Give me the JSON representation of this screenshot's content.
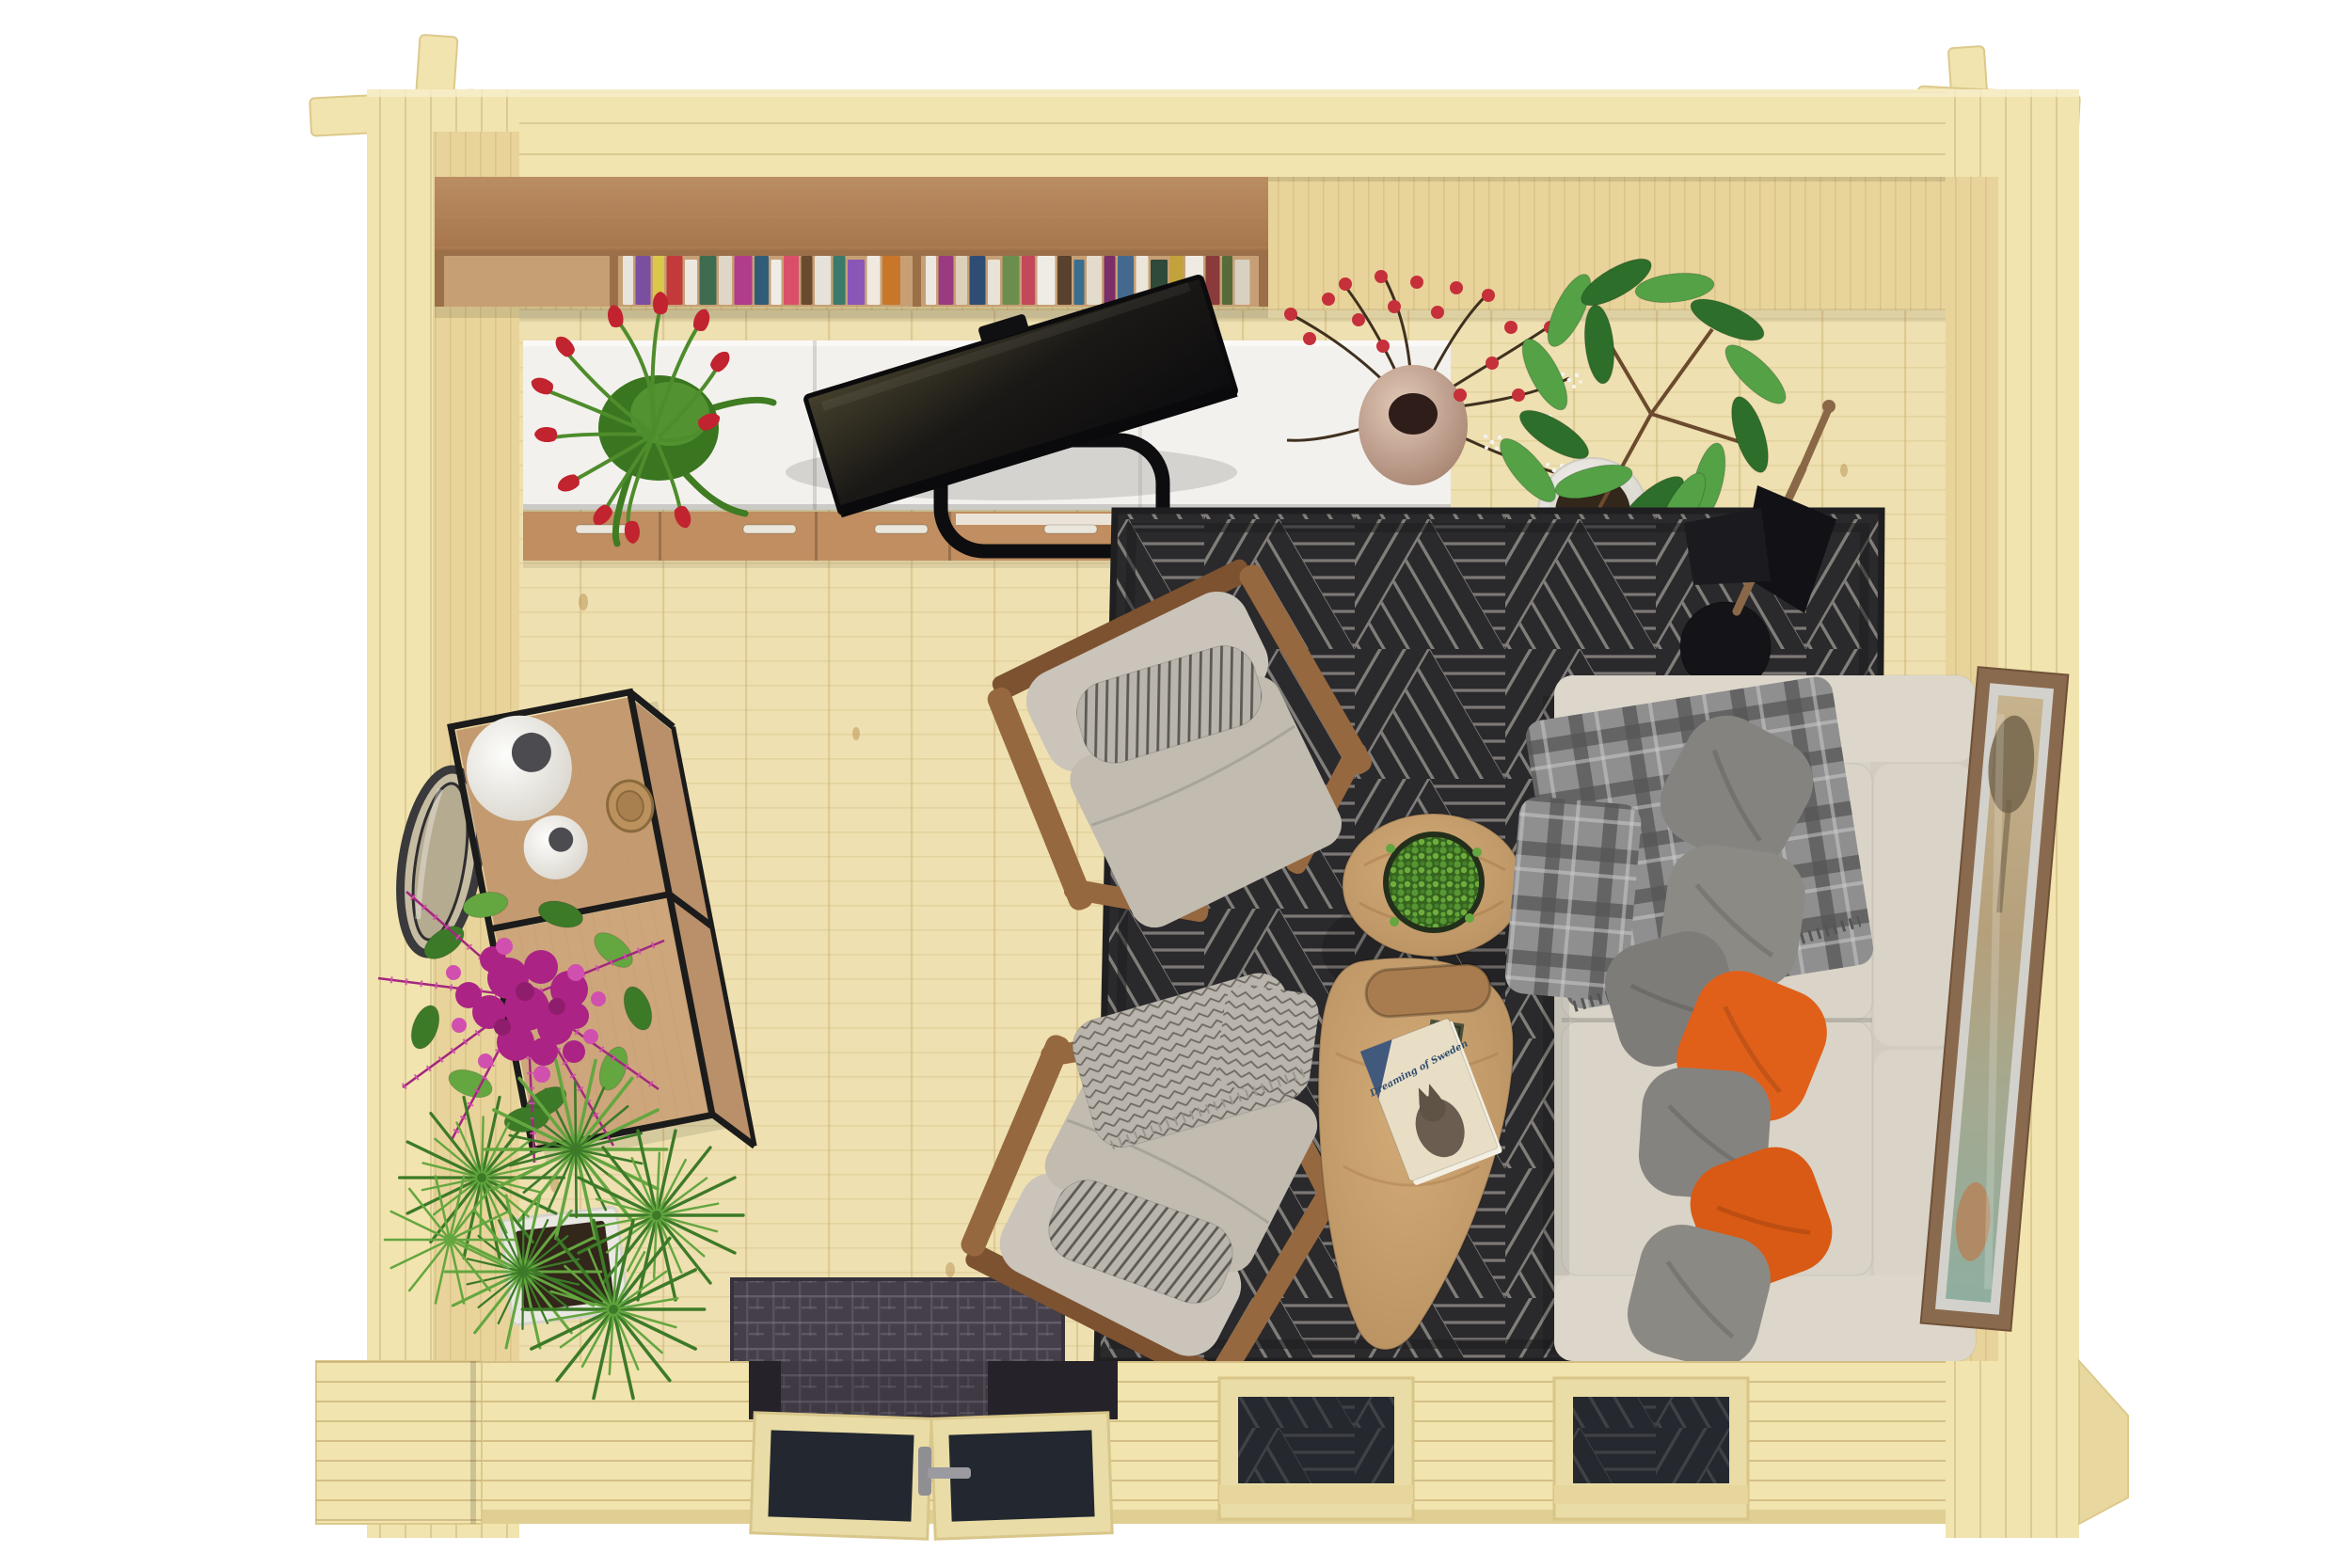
{
  "scene": {
    "description": "Top-down 3D render of a furnished log-cabin garden room (living room with sofa, armchairs, rug, desk wall and plants)",
    "book_title": "Dreaming of Sweden"
  },
  "palette": {
    "bg": "#ffffff",
    "wallTop": "#f1e4ae",
    "wallFace": "#e8d49a",
    "wallLine": "#b89a5e",
    "floor": "#eee0b0",
    "floorLine": "#c8ab6a",
    "shelfFront": "#c79f74",
    "shelfEdge": "#9b7048",
    "deskTop": "#f3f1ed",
    "drawer": "#c08e60",
    "handle": "#eae6db",
    "rugBase": "#2a292c",
    "rugLine": "#97938d",
    "mat": "#443f49",
    "matLine": "#7a7484",
    "sofa": "#d7d1c6",
    "sofaCushion": "#d9d3c8",
    "armrest": "#dcd6cb",
    "pillowGray": "#85837f",
    "pillowOrange": "#e0601a",
    "plaid": "#8f8f8f",
    "plaidDark": "#555555",
    "herr": "#b9b5ad",
    "chairCushion": "#cac4ba",
    "chairSeat": "#c1bbb0",
    "wood": "#96683f",
    "woodDark": "#7d5230",
    "table": "#c79d6a",
    "tableDark": "#b08452",
    "metal": "#1b1b1b",
    "consoleWood": "#c49a70",
    "vase": "#f2f0ec",
    "vaseHole": "#4c4c50",
    "flower": "#ab2384",
    "flowerLight": "#d14fae",
    "leaf": "#3c7a28",
    "leafLight": "#64a63f",
    "tulip": "#c1232f",
    "berry": "#c5303a",
    "branch": "#40301f",
    "ficus": "#2d6e2b",
    "ficusLight": "#54a146",
    "pot": "#eae8e2",
    "soil": "#33261a",
    "lampWood": "#8a6847",
    "frameWood": "#8a6a4e",
    "frameMat": "#d3d1cc",
    "glass": "#232830",
    "doorWood": "#e9dca6",
    "bookCover": "#e8dec6",
    "bookTitle": "#314e6e"
  },
  "bookshelf": {
    "left_spines": [
      "#e8e4dc",
      "#7a4fa0",
      "#d9c84a",
      "#c23a3a",
      "#ece8e0",
      "#3f6b4f",
      "#e0d6c8",
      "#b03c8c",
      "#2f5d78",
      "#efece6",
      "#d94f6a",
      "#6a4a2f",
      "#e6e2da",
      "#3a7a6a",
      "#8a56b8",
      "#efe9e0",
      "#c8762a"
    ],
    "right_spines": [
      "#ece8e0",
      "#9a3a80",
      "#ddd0b8",
      "#2f4d74",
      "#e8e2d8",
      "#6b8e4e",
      "#c2485a",
      "#efece6",
      "#58422e",
      "#3a6e8e",
      "#e3dccd",
      "#7a2f68",
      "#44698e",
      "#ece6da",
      "#2f4a38",
      "#c2a23a",
      "#efebe2",
      "#8a3a3a",
      "#556b3a",
      "#d8d0c0"
    ]
  }
}
